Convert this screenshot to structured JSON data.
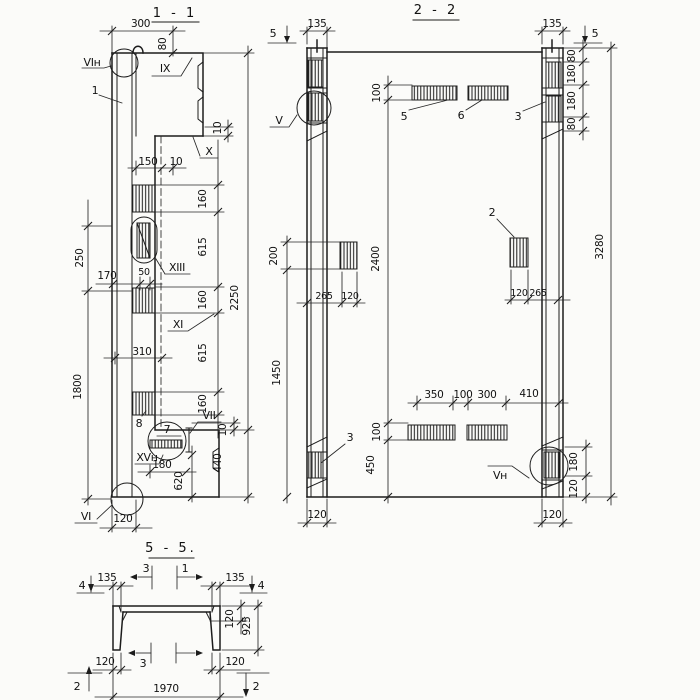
{
  "s11": {
    "title": "1 - 1",
    "dims": {
      "d300": "300",
      "d80": "80",
      "d150": "150",
      "d10a": "10",
      "d10b": "10",
      "d10c": "10",
      "d160a": "160",
      "d615a": "615",
      "d160b": "160",
      "d615b": "615",
      "d160c": "160",
      "d2250": "2250",
      "d250": "250",
      "d1800": "1800",
      "d170": "170",
      "d50": "50",
      "d310": "310",
      "d440": "440",
      "d620": "620",
      "d180": "180",
      "d120": "120"
    },
    "labels": {
      "n1": "1",
      "n7": "7",
      "n8": "8",
      "vin": "VIн",
      "vi": "VI",
      "ix": "IX",
      "x": "X",
      "xiii": "XIII",
      "xi": "XI",
      "vii": "VII",
      "xvn": "XVн"
    }
  },
  "s22": {
    "title": "2 - 2",
    "dims": {
      "d135l": "135",
      "d135r": "135",
      "d80a": "80",
      "d180a": "180",
      "d180b": "180",
      "d80b": "80",
      "d100t": "100",
      "d2400": "2400",
      "d100b": "100",
      "d450": "450",
      "d200": "200",
      "d1450": "1450",
      "d3280": "3280",
      "d265l": "265",
      "d120l": "120",
      "d120r": "120",
      "d265r": "265",
      "d350": "350",
      "d100m": "100",
      "d300": "300",
      "d410": "410",
      "d180s": "180",
      "d120s": "120",
      "d120cl": "120",
      "d120cr": "120"
    },
    "labels": {
      "n2": "2",
      "n3a": "3",
      "n3b": "3",
      "n5": "5",
      "n6": "6",
      "v": "V",
      "vn": "Vн",
      "m5l": "5",
      "m5r": "5"
    }
  },
  "s55": {
    "title": "5 - 5.",
    "dims": {
      "d135l": "135",
      "d135r": "135",
      "d120fl": "120",
      "d925": "925",
      "d120bl": "120",
      "d120br": "120",
      "d1970": "1970"
    },
    "markers": {
      "m4l": "4",
      "m4r": "4",
      "m2l": "2",
      "m2r": "2",
      "m3t": "3",
      "m1t": "1",
      "m3b": "3"
    }
  }
}
